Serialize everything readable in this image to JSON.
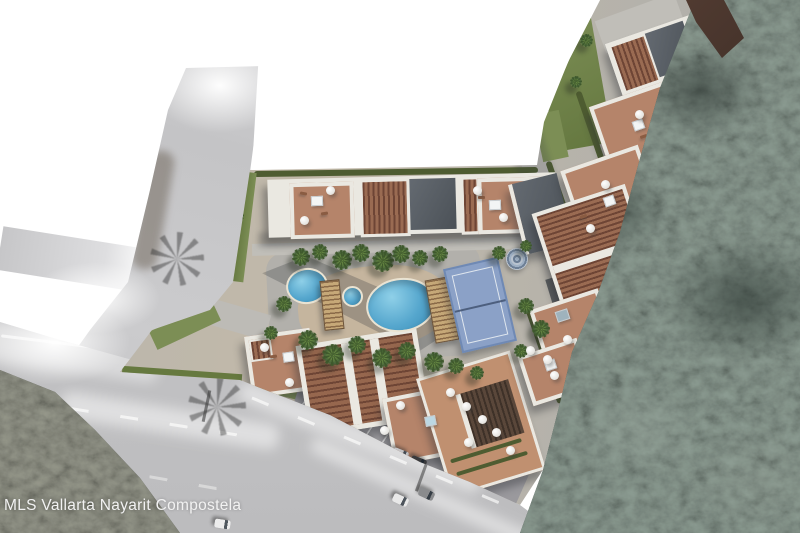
{
  "watermark": {
    "text": "MLS Vallarta Nayarit Compostela"
  },
  "colors": {
    "pool-blue": "#55a6cd",
    "pool-light": "#8fd0e8",
    "court-blue": "#8ba1c7",
    "terracotta": "#b5846a",
    "pergola-dark": "#6e4535",
    "pergola-light": "#9a6b52",
    "roof-white": "#eae8e1",
    "slate": "#5b6167",
    "asphalt": "#c6c6c8",
    "grass": "#7c8e55",
    "hedge": "#4e5c31",
    "sand": "#c7b69c",
    "cabana-tan": "#c6a878",
    "boundary-brown": "#5e4337",
    "watermark-text": "#f2f2f2"
  }
}
